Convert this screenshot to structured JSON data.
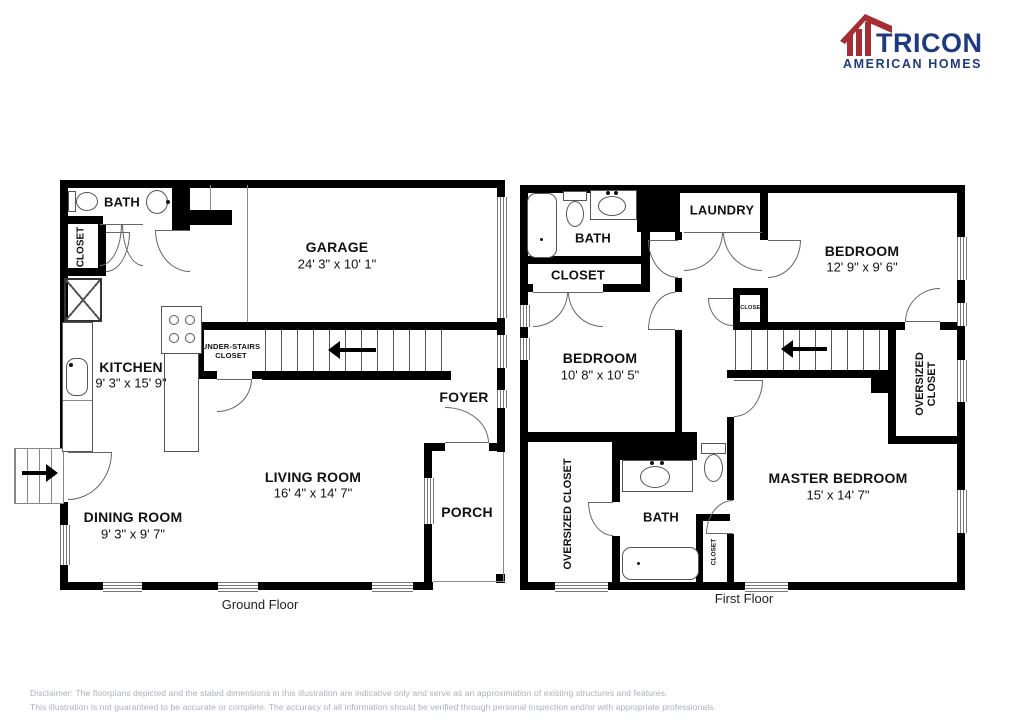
{
  "logo": {
    "brand": "TRICON",
    "sub": "AMERICAN HOMES",
    "red": "#A52E35",
    "navy": "#1E3A80"
  },
  "ground": {
    "floor_label": "Ground Floor",
    "bath": "BATH",
    "closet": "CLOSET",
    "garage_name": "GARAGE",
    "garage_dims": "24' 3\" x 10' 1\"",
    "kitchen_name": "KITCHEN",
    "kitchen_dims": "9' 3\" x 15' 9\"",
    "understairs": "UNDER-STAIRS CLOSET",
    "foyer": "FOYER",
    "living_name": "LIVING ROOM",
    "living_dims": "16' 4\" x 14' 7\"",
    "dining_name": "DINING ROOM",
    "dining_dims": "9' 3\" x 9' 7\"",
    "porch": "PORCH"
  },
  "first": {
    "floor_label": "First Floor",
    "bath_top": "BATH",
    "closet_top": "CLOSET",
    "laundry": "LAUNDRY",
    "bedroom1_name": "BEDROOM",
    "bedroom1_dims": "12' 9\" x 9' 6\"",
    "closet_small": "CLOSET",
    "bedroom2_name": "BEDROOM",
    "bedroom2_dims": "10' 8\" x 10' 5\"",
    "oversized_left": "OVERSIZED CLOSET",
    "oversized_right": "OVERSIZED CLOSET",
    "master_name": "MASTER BEDROOM",
    "master_dims": "15' x 14' 7\"",
    "bath_bottom": "BATH",
    "closet_bottom": "CLOSET"
  },
  "disclaimer": {
    "line1": "Disclaimer: The floorplans depicted and the stated dimensions in this illustration are indicative only and serve as an approximation of existing structures and features.",
    "line2": "This illustration is not guaranteed to be accurate or complete. The accuracy of all information should be verified through personal inspection and/or with appropriate professionals."
  }
}
